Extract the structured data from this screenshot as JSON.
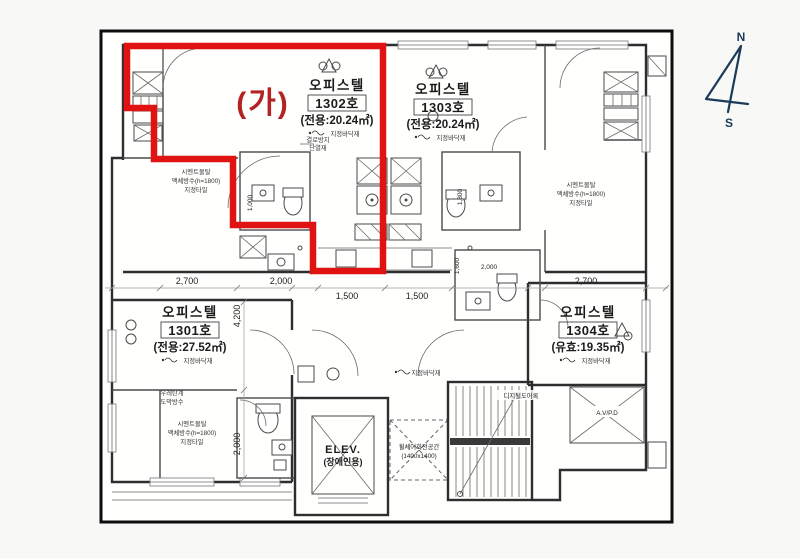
{
  "page": {
    "background": "#f8f8f6",
    "paper": "#fffffe"
  },
  "colors": {
    "outline_red": "#e01212",
    "label_red": "#b32323",
    "compass_navy": "#1c3a5a"
  },
  "highlight": {
    "label": "(가)"
  },
  "units": {
    "u1302": {
      "type": "오피스텔",
      "number": "1302호",
      "area": "(전용:20.24㎡)",
      "floor_note": "지정바닥재"
    },
    "u1303": {
      "type": "오피스텔",
      "number": "1303호",
      "area": "(전용:20.24㎡)",
      "floor_note": "지정바닥재"
    },
    "u1301": {
      "type": "오피스텔",
      "number": "1301호",
      "area": "(전용:27.52㎡)",
      "floor_note": "지정바닥재"
    },
    "u1304": {
      "type": "오피스텔",
      "number": "1304호",
      "area": "(유효:19.35㎡)",
      "floor_note": "지정바닥재"
    }
  },
  "core": {
    "elevator": "ELEV.",
    "elevator_use": "(장애인용)",
    "duct": "A.V/P.D",
    "wheelchair_space": "휠체어회전공간",
    "wheelchair_size": "(1400x1400)",
    "door_note": "디지털도어록",
    "corridor_floor_note": "지정바닥재"
  },
  "finish_notes": {
    "cement1": "시멘트몰탈",
    "cement2": "액체방수(h=1800)",
    "cement3": "지정타일",
    "urethane1": "우레탄계",
    "urethane2": "도막방수",
    "condensation1": "결로방지",
    "condensation2": "단열재"
  },
  "dimensions": {
    "d2700": "2,700",
    "d2000": "2,000",
    "d1500": "1,500",
    "d4200": "4,200",
    "d1000": "1,000",
    "d1800": "1,800",
    "d1600": "1,600"
  },
  "compass": {
    "north": "N",
    "south": "S"
  }
}
